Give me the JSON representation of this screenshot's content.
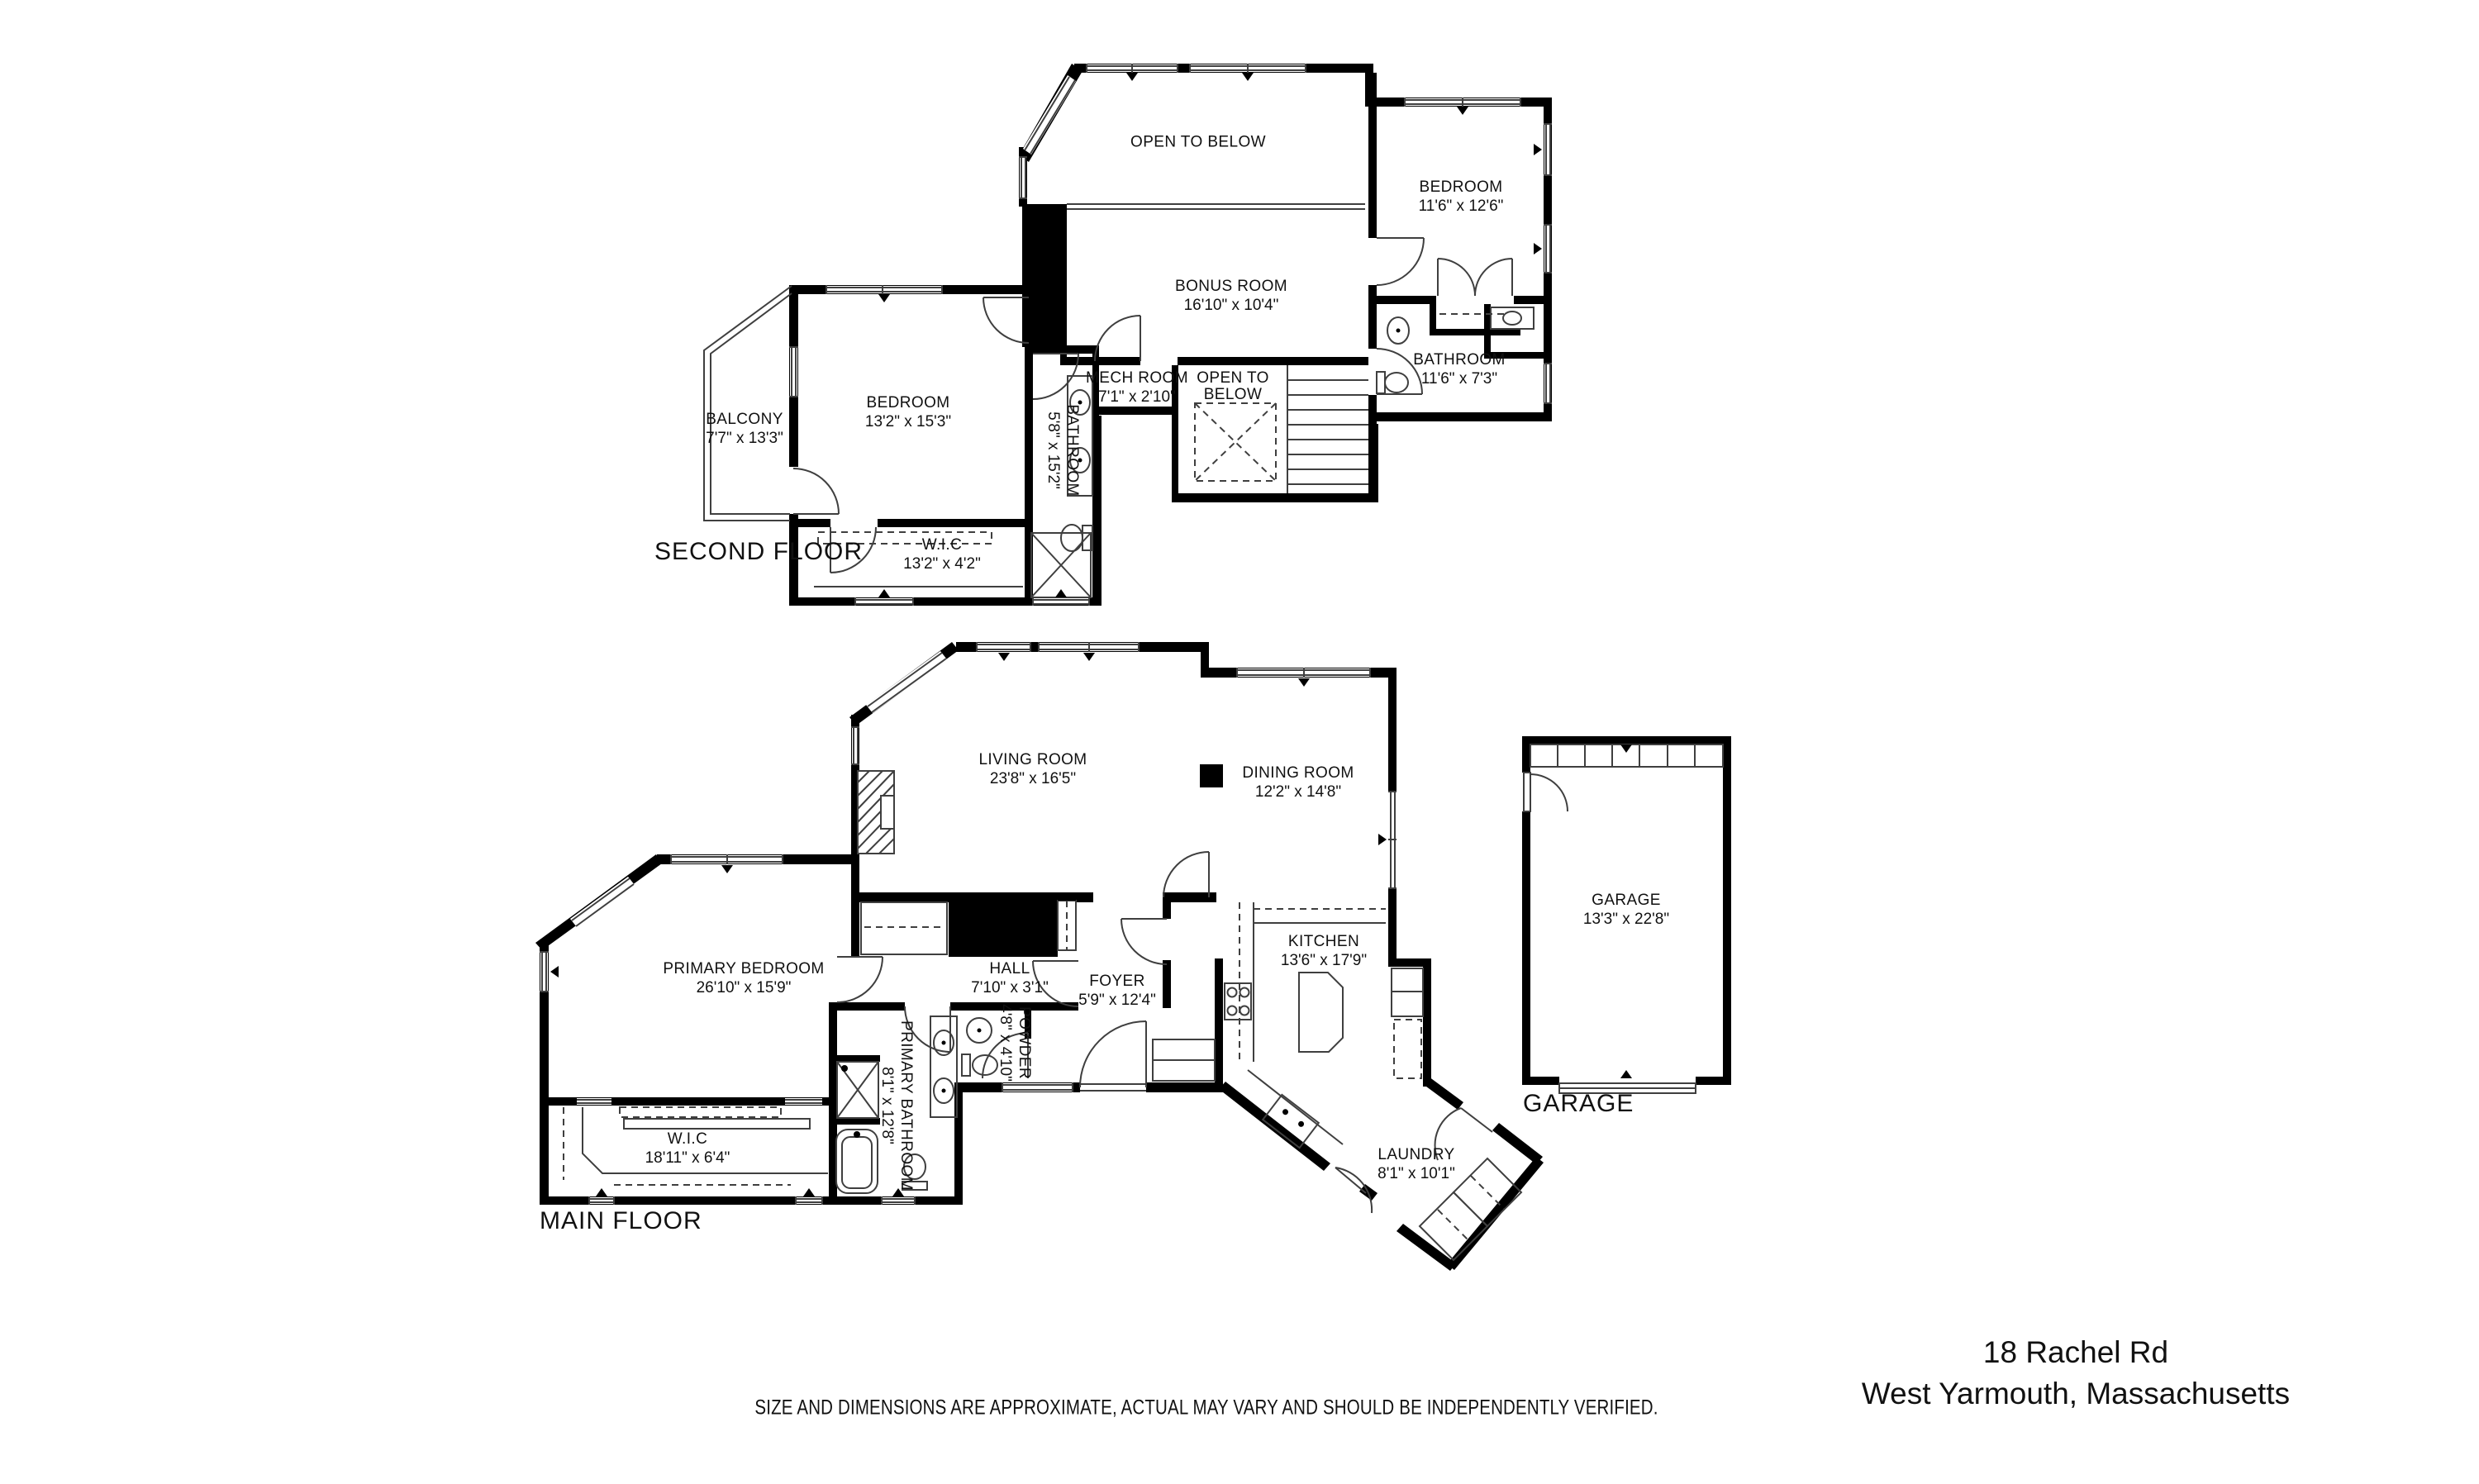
{
  "colors": {
    "walls": "#000000",
    "lines": "#3f3f3f",
    "background": "#ffffff",
    "text": "#111111"
  },
  "address": {
    "line1": "18 Rachel Rd",
    "line2": "West Yarmouth, Massachusetts"
  },
  "footer": {
    "disclaimer": "SIZE AND DIMENSIONS ARE APPROXIMATE, ACTUAL MAY VARY AND SHOULD BE INDEPENDENTLY VERIFIED."
  },
  "floors": [
    {
      "id": "second-floor",
      "title": "SECOND FLOOR",
      "rooms": [
        {
          "name": "OPEN TO BELOW",
          "dims": ""
        },
        {
          "name": "BEDROOM",
          "dims": "11'6\" x 12'6\""
        },
        {
          "name": "BONUS ROOM",
          "dims": "16'10\" x 10'4\""
        },
        {
          "name": "MECH ROOM",
          "dims": "7'1\" x 2'10\""
        },
        {
          "name": "OPEN TO BELOW",
          "dims": ""
        },
        {
          "name": "BATHROOM",
          "dims": "11'6\" x 7'3\""
        },
        {
          "name": "BEDROOM",
          "dims": "13'2\" x 15'3\""
        },
        {
          "name": "BALCONY",
          "dims": "7'7\" x 13'3\""
        },
        {
          "name": "BATHROOM",
          "dims": "5'8\" x 15'2\""
        },
        {
          "name": "W.I.C",
          "dims": "13'2\" x 4'2\""
        }
      ]
    },
    {
      "id": "main-floor",
      "title": "MAIN FLOOR",
      "rooms": [
        {
          "name": "LIVING ROOM",
          "dims": "23'8\" x 16'5\""
        },
        {
          "name": "DINING ROOM",
          "dims": "12'2\" x 14'8\""
        },
        {
          "name": "PRIMARY BEDROOM",
          "dims": "26'10\" x 15'9\""
        },
        {
          "name": "HALL",
          "dims": "7'10\" x 3'1\""
        },
        {
          "name": "FOYER",
          "dims": "5'9\" x 12'4\""
        },
        {
          "name": "KITCHEN",
          "dims": "13'6\" x 17'9\""
        },
        {
          "name": "POWDER",
          "dims": "4'8\" x 4'10\""
        },
        {
          "name": "PRIMARY BATHROOM",
          "dims": "8'1\" x 12'8\""
        },
        {
          "name": "W.I.C",
          "dims": "18'11\" x 6'4\""
        },
        {
          "name": "LAUNDRY",
          "dims": "8'1\" x 10'1\""
        }
      ]
    },
    {
      "id": "garage",
      "title": "GARAGE",
      "rooms": [
        {
          "name": "GARAGE",
          "dims": "13'3\" x 22'8\""
        }
      ]
    }
  ]
}
